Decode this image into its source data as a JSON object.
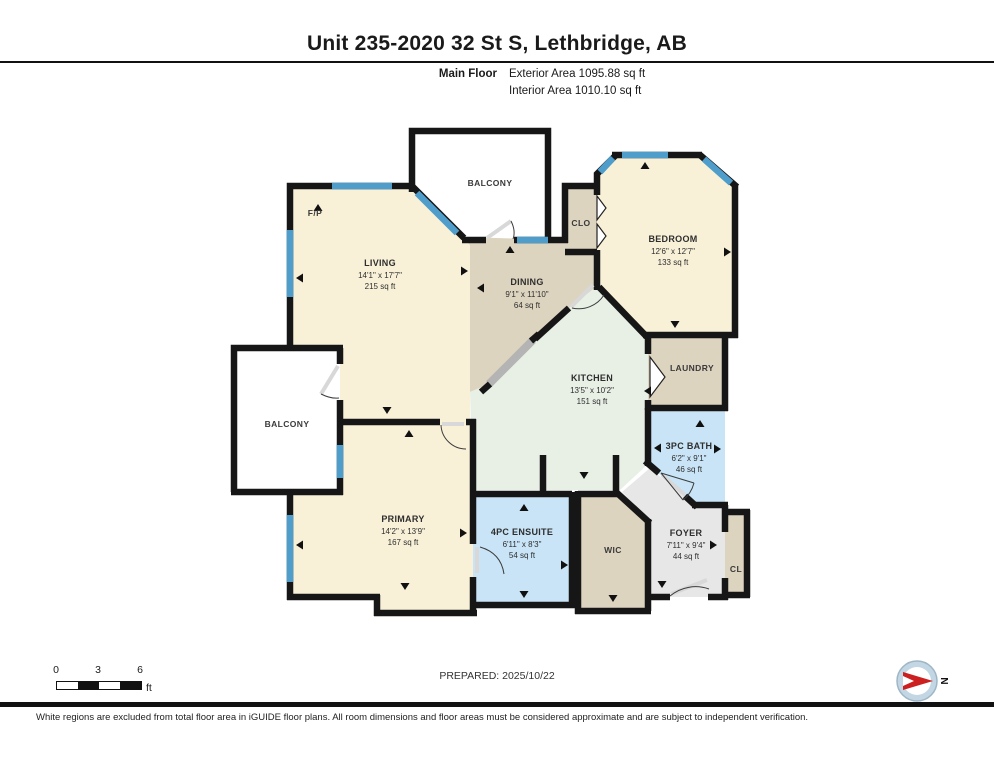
{
  "header": {
    "title": "Unit 235-2020 32 St S, Lethbridge, AB",
    "floor_label": "Main Floor",
    "exterior_area": "Exterior Area 1095.88 sq ft",
    "interior_area": "Interior Area 1010.10 sq ft"
  },
  "rooms": [
    {
      "name": "LIVING",
      "dims": "14'1\" x 17'7\"",
      "area": "215 sq ft"
    },
    {
      "name": "DINING",
      "dims": "9'1\" x 11'10\"",
      "area": "64 sq ft"
    },
    {
      "name": "KITCHEN",
      "dims": "13'5\" x 10'2\"",
      "area": "151 sq ft"
    },
    {
      "name": "BEDROOM",
      "dims": "12'6\" x 12'7\"",
      "area": "133 sq ft"
    },
    {
      "name": "PRIMARY",
      "dims": "14'2\" x 13'9\"",
      "area": "167 sq ft"
    },
    {
      "name": "4PC ENSUITE",
      "dims": "6'11\" x 8'3\"",
      "area": "54 sq ft"
    },
    {
      "name": "3PC BATH",
      "dims": "6'2\" x 9'1\"",
      "area": "46 sq ft"
    },
    {
      "name": "FOYER",
      "dims": "7'11\" x 9'4\"",
      "area": "44 sq ft"
    }
  ],
  "labels": {
    "balcony_top": "BALCONY",
    "balcony_left": "BALCONY",
    "clo": "CLO",
    "laundry": "LAUNDRY",
    "wic": "WIC",
    "cl": "CL",
    "fp": "F/P"
  },
  "scale_bar": {
    "ticks": [
      "0",
      "3",
      "6"
    ],
    "unit": "ft"
  },
  "footer": {
    "prepared": "PREPARED: 2025/10/22",
    "disclaimer": "White regions are excluded from total floor area in iGUIDE floor plans. All room dimensions and floor areas must be considered approximate and are subject to independent verification."
  },
  "compass": {
    "north": "N"
  },
  "colors": {
    "wall": "#161616",
    "room_cream": "#f8f1d8",
    "room_tan": "#ddd4c0",
    "room_green": "#e8f0e6",
    "room_blue": "#c8e4f6",
    "room_gray": "#e7e7e7",
    "window_blue": "#4f9dcb",
    "balcony_white": "#ffffff",
    "compass_red": "#cc1f1f"
  }
}
